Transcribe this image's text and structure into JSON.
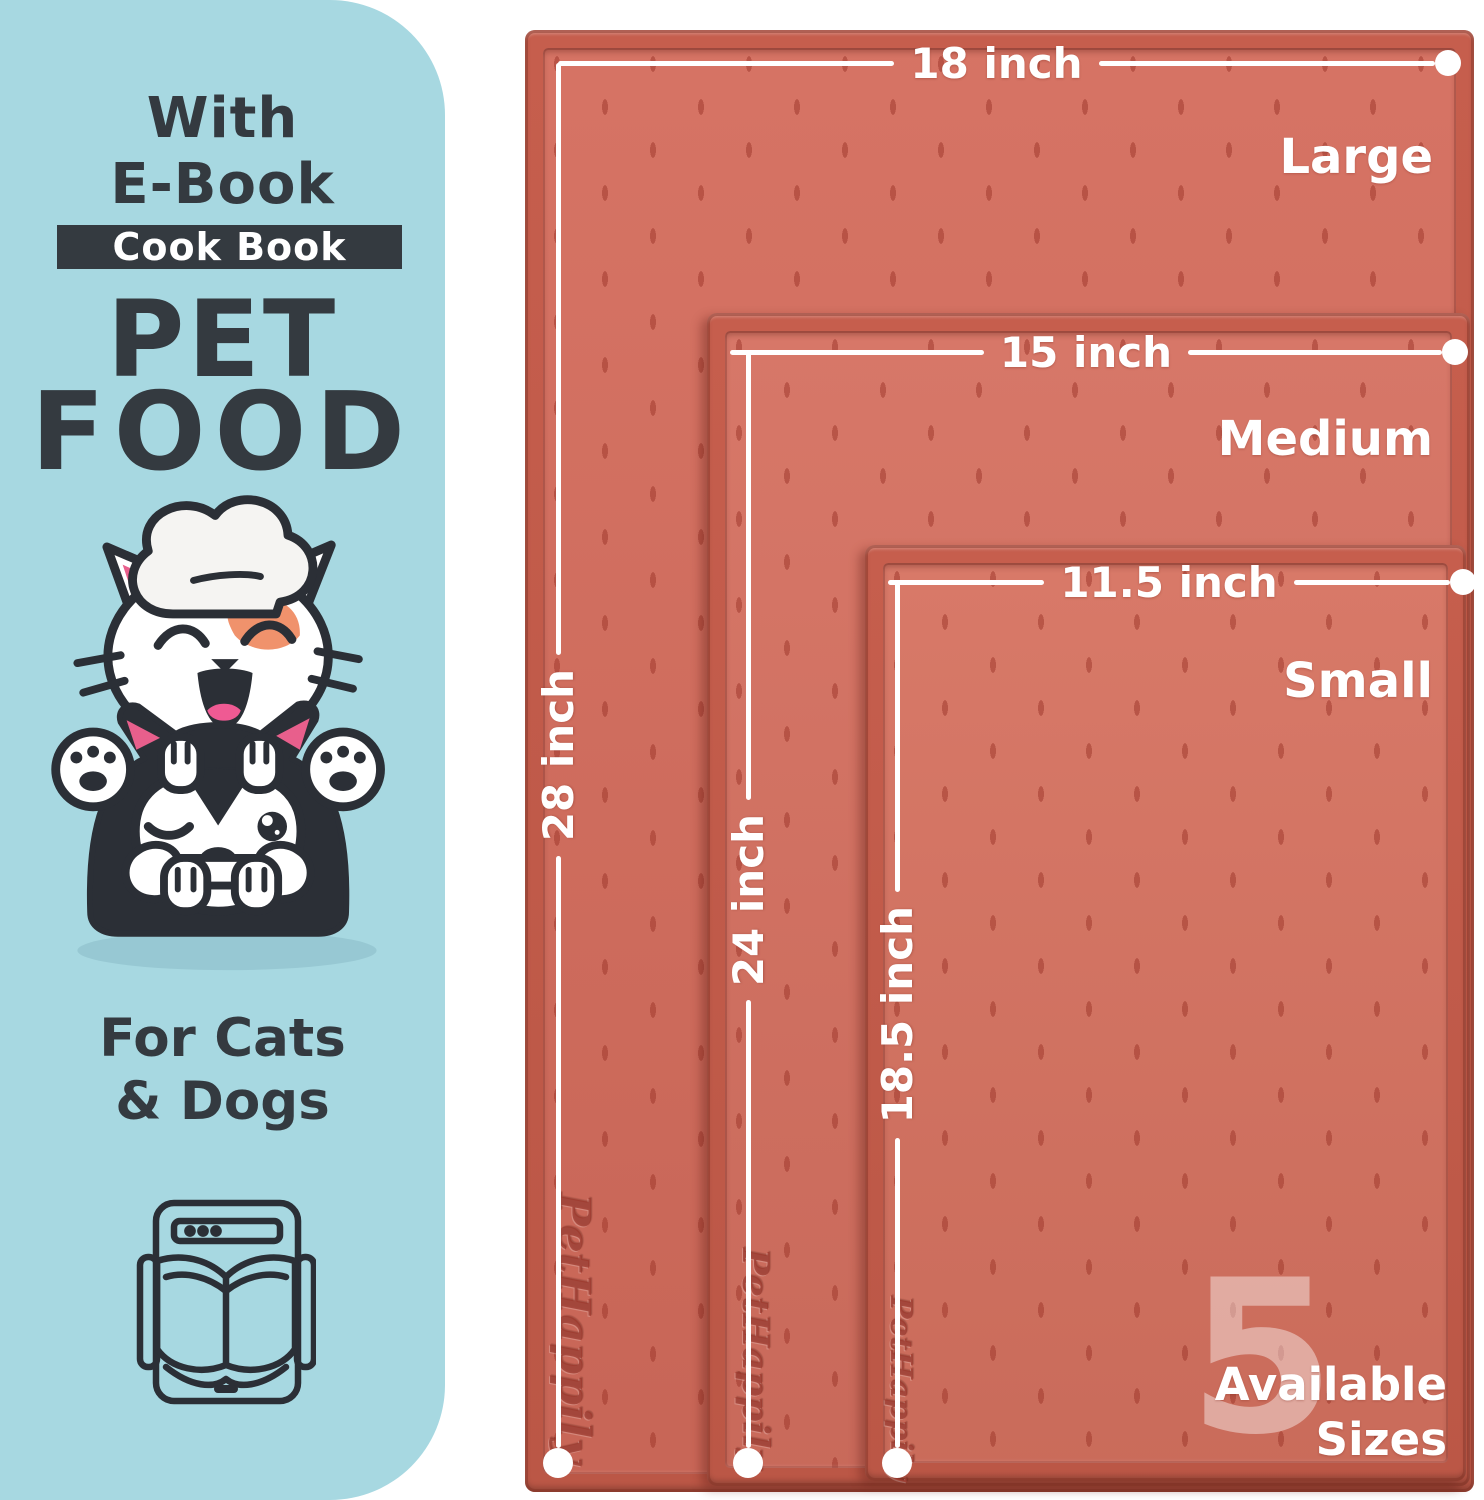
{
  "sidebar": {
    "bg_color": "#a7d8e1",
    "ink_color": "#343a40",
    "with_label": "With",
    "ebook_label": "E-Book",
    "badge_label": "Cook Book",
    "title_line1": "PET",
    "title_line2": "FOOD",
    "subtitle_line1": "For Cats",
    "subtitle_line2": "& Dogs",
    "illustration": "cat-chef-on-husky-dog-with-bone",
    "footer_icon": "ebook-tablet-open-book-icon"
  },
  "mats": [
    {
      "name": "Large",
      "width_label": "18 inch",
      "height_label": "28 inch",
      "embossed_logo": "PetHappily",
      "color": "#d46c5c"
    },
    {
      "name": "Medium",
      "width_label": "15 inch",
      "height_label": "24 inch",
      "embossed_logo": "PetHappily",
      "color": "#d57060"
    },
    {
      "name": "Small",
      "width_label": "11.5 inch",
      "height_label": "18.5 inch",
      "embossed_logo": "PetHappily",
      "color": "#d67260"
    }
  ],
  "sizes_badge": {
    "number": "5",
    "line1": "Available",
    "line2": "Sizes"
  },
  "colors": {
    "mat_rim": "#c05a4a",
    "measure_line": "#ffffff",
    "orange_patch": "#f0926c",
    "pink_ear": "#e85f8c",
    "outline_dark": "#2b2f36",
    "shadow_teal": "#8fc0cb"
  }
}
